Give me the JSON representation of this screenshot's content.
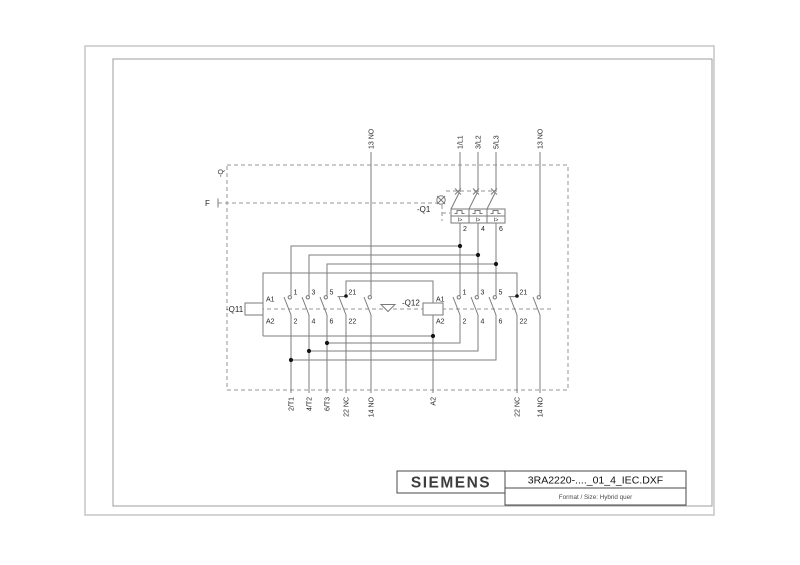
{
  "title_block": {
    "brand": "SIEMENS",
    "filename": "3RA2220-...._01_4_IEC.DXF",
    "format_info": "Format / Size: Hybrid quer"
  },
  "enclosure": {
    "label": "-Q",
    "trip_label": "F"
  },
  "breaker": {
    "name": "-Q1",
    "line_terminals": [
      "1/L1",
      "3/L2",
      "5/L3"
    ],
    "load_terminals": [
      "2",
      "4",
      "6"
    ],
    "magnetic_release": "I>"
  },
  "aux": {
    "q11_no_top": "13 NO",
    "q11_no_bottom": "14 NO",
    "q12_no_top": "13 NO",
    "q12_no_bottom": "14 NO"
  },
  "q11": {
    "name": "-Q11",
    "coil": {
      "a1": "A1",
      "a2": "A2"
    },
    "poles": [
      {
        "t": "1",
        "b": "2"
      },
      {
        "t": "3",
        "b": "4"
      },
      {
        "t": "5",
        "b": "6"
      }
    ],
    "nc": {
      "t": "21",
      "b": "22"
    }
  },
  "q12": {
    "name": "-Q12",
    "coil": {
      "a1": "A1",
      "a2": "A2"
    },
    "poles": [
      {
        "t": "1",
        "b": "2"
      },
      {
        "t": "3",
        "b": "4"
      },
      {
        "t": "5",
        "b": "6"
      }
    ],
    "nc": {
      "t": "21",
      "b": "22"
    }
  },
  "bottom_terminals": [
    "2/T1",
    "4/T2",
    "6/T3",
    "22 NC",
    "14 NO",
    "A2",
    "22 NC",
    "14 NO"
  ]
}
